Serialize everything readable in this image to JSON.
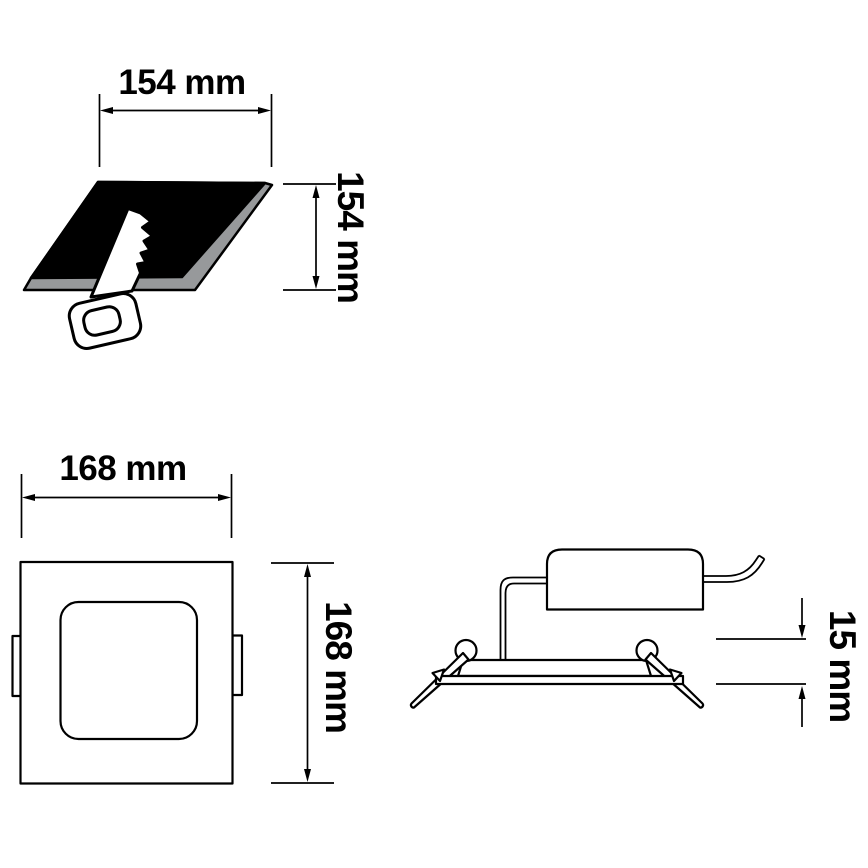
{
  "labels": {
    "cutout_width": "154 mm",
    "cutout_height": "154 mm",
    "panel_width": "168 mm",
    "panel_height": "168 mm",
    "recess_depth": "15 mm"
  },
  "colors": {
    "background": "#ffffff",
    "line": "#000000",
    "cutout_fill": "#000000",
    "cutout_edge": "#97999b"
  }
}
